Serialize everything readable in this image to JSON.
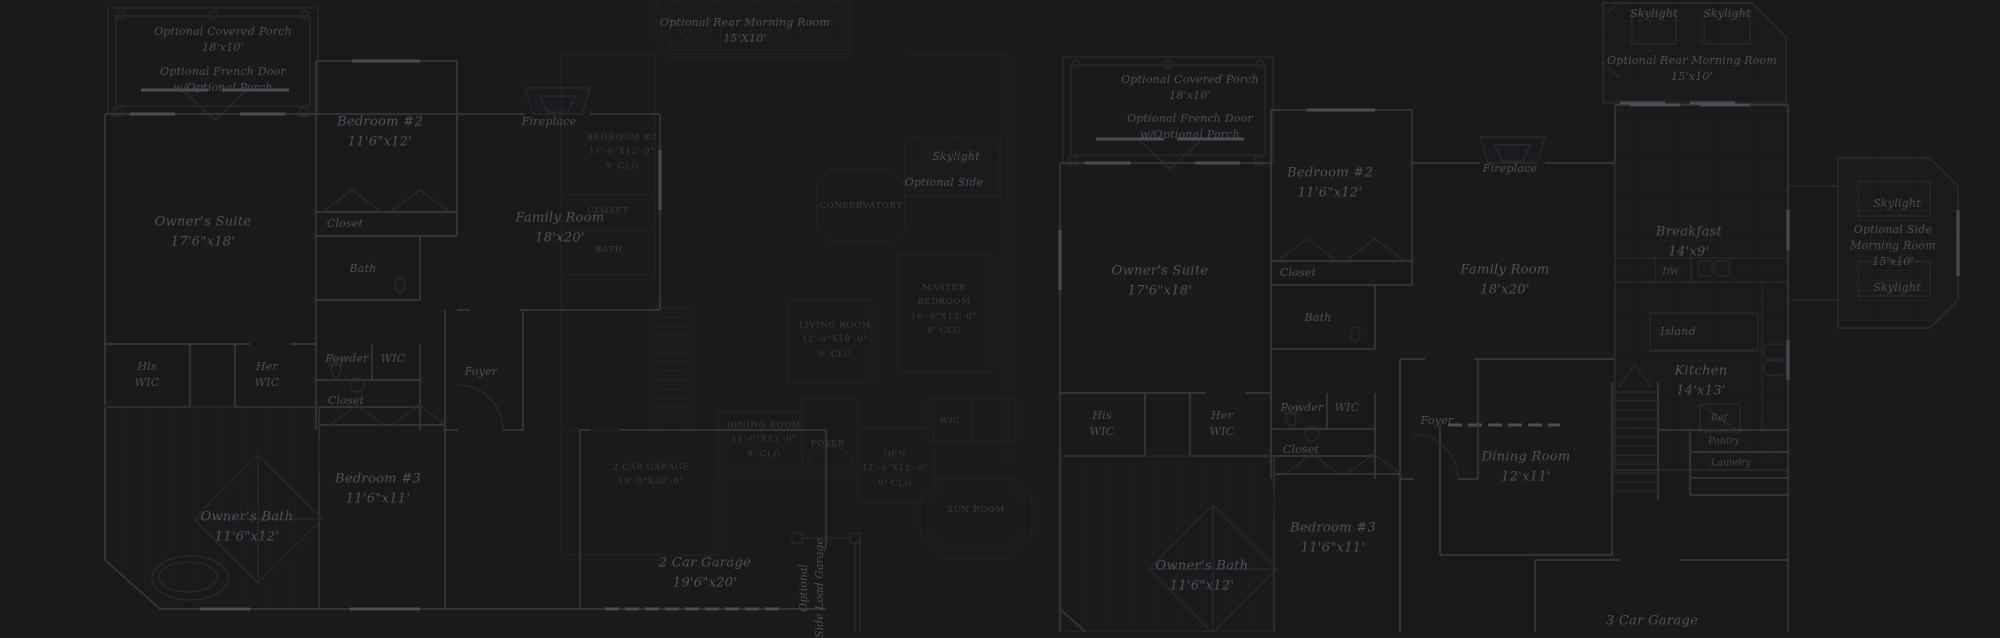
{
  "canvas": {
    "width": 2000,
    "height": 632,
    "background": "#1a191b"
  },
  "palette": {
    "wall": "#343236",
    "wall_faint": "#262429",
    "wall_bright": "#4e4c52",
    "grid_line": "#2e2c30",
    "label_text": "#564f58",
    "label_text_dim": "#3e3a41"
  },
  "labels": [
    {
      "id": "label-optional-covered-porch-a",
      "text": "Optional Covered Porch\n18'x10'",
      "x": 223,
      "y": 40,
      "style": "small"
    },
    {
      "id": "label-optional-french-door-a",
      "text": "Optional French Door\nw/Optional Porch",
      "x": 223,
      "y": 80,
      "style": "small"
    },
    {
      "id": "label-bedroom-2-a",
      "text": "Bedroom #2\n11'6\"x12'",
      "x": 380,
      "y": 132,
      "style": "room"
    },
    {
      "id": "label-closet-bedroom-2-a",
      "text": "Closet",
      "x": 345,
      "y": 224,
      "style": "small"
    },
    {
      "id": "label-owners-suite-a",
      "text": "Owner's Suite\n17'6\"x18'",
      "x": 203,
      "y": 232,
      "style": "room"
    },
    {
      "id": "label-bath-a",
      "text": "Bath",
      "x": 363,
      "y": 269,
      "style": "small"
    },
    {
      "id": "label-his-wic-a",
      "text": "His\nWIC",
      "x": 147,
      "y": 375,
      "style": "small"
    },
    {
      "id": "label-her-wic-a",
      "text": "Her\nWIC",
      "x": 267,
      "y": 375,
      "style": "small"
    },
    {
      "id": "label-powder-a",
      "text": "Powder",
      "x": 347,
      "y": 359,
      "style": "small"
    },
    {
      "id": "label-wic-a",
      "text": "WIC",
      "x": 393,
      "y": 359,
      "style": "small"
    },
    {
      "id": "label-closet-a",
      "text": "Closet",
      "x": 346,
      "y": 401,
      "style": "small"
    },
    {
      "id": "label-foyer-a",
      "text": "Foyer",
      "x": 481,
      "y": 372,
      "style": "small"
    },
    {
      "id": "label-bedroom-3-a",
      "text": "Bedroom #3\n11'6\"x11'",
      "x": 378,
      "y": 489,
      "style": "room"
    },
    {
      "id": "label-owners-bath-a",
      "text": "Owner's Bath\n11'6\"x12'",
      "x": 247,
      "y": 527,
      "style": "room"
    },
    {
      "id": "label-family-room-a",
      "text": "Family Room\n18'x20'",
      "x": 560,
      "y": 228,
      "style": "room"
    },
    {
      "id": "label-fireplace-a",
      "text": "Fireplace",
      "x": 549,
      "y": 122,
      "style": "small"
    },
    {
      "id": "label-garage-a",
      "text": "2 Car Garage\n19'6\"x20'",
      "x": 705,
      "y": 573,
      "style": "room"
    },
    {
      "id": "label-side-load-garage-a",
      "text": "Optional\nSide Load Garage",
      "x": 812,
      "y": 588,
      "style": "vert"
    },
    {
      "id": "label-skylight-a",
      "text": "Skylight",
      "x": 956,
      "y": 157,
      "style": "small"
    },
    {
      "id": "label-optional-side-a",
      "text": "Optional Side",
      "x": 944,
      "y": 183,
      "style": "small"
    },
    {
      "id": "label-rear-morning-room-b",
      "text": "Optional Rear Morning Room\n15'X10'",
      "x": 745,
      "y": 31,
      "style": "small"
    },
    {
      "id": "label-bedroom-2-b",
      "text": "Bedroom #2\n11'-0\"x12'-0\"\n9' Clg",
      "x": 622,
      "y": 152,
      "style": "caps"
    },
    {
      "id": "label-conservatory-b",
      "text": "Conservatory",
      "x": 861,
      "y": 206,
      "style": "caps"
    },
    {
      "id": "label-closet-b",
      "text": "Closet",
      "x": 608,
      "y": 211,
      "style": "caps"
    },
    {
      "id": "label-bath-b",
      "text": "Bath",
      "x": 609,
      "y": 250,
      "style": "caps"
    },
    {
      "id": "label-master-bedroom-b",
      "text": "Master\nBedroom\n16'-0\"x13'-0\"\n9' Clg",
      "x": 944,
      "y": 310,
      "style": "caps"
    },
    {
      "id": "label-living-room-b",
      "text": "Living Room\n12'-0\"x18'-0\"\n9' Clg",
      "x": 835,
      "y": 340,
      "style": "caps"
    },
    {
      "id": "label-dining-room-b",
      "text": "Dining Room\n11'-0\"x13'-0\"\n9' Clg",
      "x": 764,
      "y": 440,
      "style": "caps"
    },
    {
      "id": "label-foyer-b",
      "text": "Foyer",
      "x": 828,
      "y": 444,
      "style": "caps"
    },
    {
      "id": "label-den-b",
      "text": "Den\n11'-0\"x12'-0\"\n9' Clg",
      "x": 895,
      "y": 469,
      "style": "caps"
    },
    {
      "id": "label-garage-b",
      "text": "2 Car Garage\n19'-0\"x20'-0\"",
      "x": 651,
      "y": 475,
      "style": "caps"
    },
    {
      "id": "label-wic-b",
      "text": "WIC",
      "x": 950,
      "y": 421,
      "style": "caps"
    },
    {
      "id": "label-sun-room-b",
      "text": "Sun Room",
      "x": 976,
      "y": 510,
      "style": "caps"
    },
    {
      "id": "label-optional-covered-porch-c",
      "text": "Optional Covered Porch\n18'x10'",
      "x": 1190,
      "y": 88,
      "style": "small"
    },
    {
      "id": "label-optional-french-door-c",
      "text": "Optional French Door\nw/Optional Porch",
      "x": 1190,
      "y": 127,
      "style": "small"
    },
    {
      "id": "label-bedroom-2-c",
      "text": "Bedroom #2\n11'6\"x12'",
      "x": 1330,
      "y": 183,
      "style": "room"
    },
    {
      "id": "label-closet-bedroom-2-c",
      "text": "Closet",
      "x": 1298,
      "y": 273,
      "style": "small"
    },
    {
      "id": "label-owners-suite-c",
      "text": "Owner's Suite\n17'6\"x18'",
      "x": 1160,
      "y": 281,
      "style": "room"
    },
    {
      "id": "label-bath-c",
      "text": "Bath",
      "x": 1318,
      "y": 318,
      "style": "small"
    },
    {
      "id": "label-family-room-c",
      "text": "Family Room\n18'x20'",
      "x": 1505,
      "y": 280,
      "style": "room"
    },
    {
      "id": "label-fireplace-c",
      "text": "Fireplace",
      "x": 1510,
      "y": 169,
      "style": "small"
    },
    {
      "id": "label-breakfast-c",
      "text": "Breakfast\n14'x9'",
      "x": 1689,
      "y": 242,
      "style": "room"
    },
    {
      "id": "label-dw-c",
      "text": "DW",
      "x": 1671,
      "y": 272,
      "style": "tiny"
    },
    {
      "id": "label-island-c",
      "text": "Island",
      "x": 1678,
      "y": 332,
      "style": "small"
    },
    {
      "id": "label-kitchen-c",
      "text": "Kitchen\n14'x13'",
      "x": 1701,
      "y": 381,
      "style": "room"
    },
    {
      "id": "label-ref-c",
      "text": "Ref",
      "x": 1719,
      "y": 418,
      "style": "tiny"
    },
    {
      "id": "label-pantry-c",
      "text": "Pantry",
      "x": 1724,
      "y": 441,
      "style": "tiny"
    },
    {
      "id": "label-laundry-c",
      "text": "Laundry",
      "x": 1731,
      "y": 463,
      "style": "tiny"
    },
    {
      "id": "label-dining-room-c",
      "text": "Dining Room\n12'x11'",
      "x": 1526,
      "y": 467,
      "style": "room"
    },
    {
      "id": "label-foyer-c",
      "text": "Foyer",
      "x": 1437,
      "y": 421,
      "style": "small"
    },
    {
      "id": "label-his-wic-c",
      "text": "His\nWIC",
      "x": 1102,
      "y": 424,
      "style": "small"
    },
    {
      "id": "label-her-wic-c",
      "text": "Her\nWIC",
      "x": 1222,
      "y": 424,
      "style": "small"
    },
    {
      "id": "label-powder-c",
      "text": "Powder",
      "x": 1302,
      "y": 408,
      "style": "small"
    },
    {
      "id": "label-wic-c",
      "text": "WIC",
      "x": 1347,
      "y": 408,
      "style": "small"
    },
    {
      "id": "label-closet-c",
      "text": "Closet",
      "x": 1301,
      "y": 450,
      "style": "small"
    },
    {
      "id": "label-bedroom-3-c",
      "text": "Bedroom #3\n11'6\"x11'",
      "x": 1333,
      "y": 538,
      "style": "room"
    },
    {
      "id": "label-owners-bath-c",
      "text": "Owner's Bath\n11'6\"x12'",
      "x": 1202,
      "y": 576,
      "style": "room"
    },
    {
      "id": "label-garage-c",
      "text": "3 Car Garage",
      "x": 1652,
      "y": 621,
      "style": "room"
    },
    {
      "id": "label-skylight-rear-1-c",
      "text": "Skylight",
      "x": 1654,
      "y": 14,
      "style": "small"
    },
    {
      "id": "label-skylight-rear-2-c",
      "text": "Skylight",
      "x": 1727,
      "y": 14,
      "style": "small"
    },
    {
      "id": "label-rear-morning-room-c",
      "text": "Optional Rear Morning Room\n15'x10'",
      "x": 1692,
      "y": 69,
      "style": "small"
    },
    {
      "id": "label-skylight-side-top-c",
      "text": "Skylight",
      "x": 1897,
      "y": 204,
      "style": "small"
    },
    {
      "id": "label-side-morning-room-c",
      "text": "Optional Side\nMorning Room\n15'x10'",
      "x": 1893,
      "y": 246,
      "style": "small"
    },
    {
      "id": "label-skylight-side-bottom-c",
      "text": "Skylight",
      "x": 1897,
      "y": 288,
      "style": "small"
    }
  ]
}
